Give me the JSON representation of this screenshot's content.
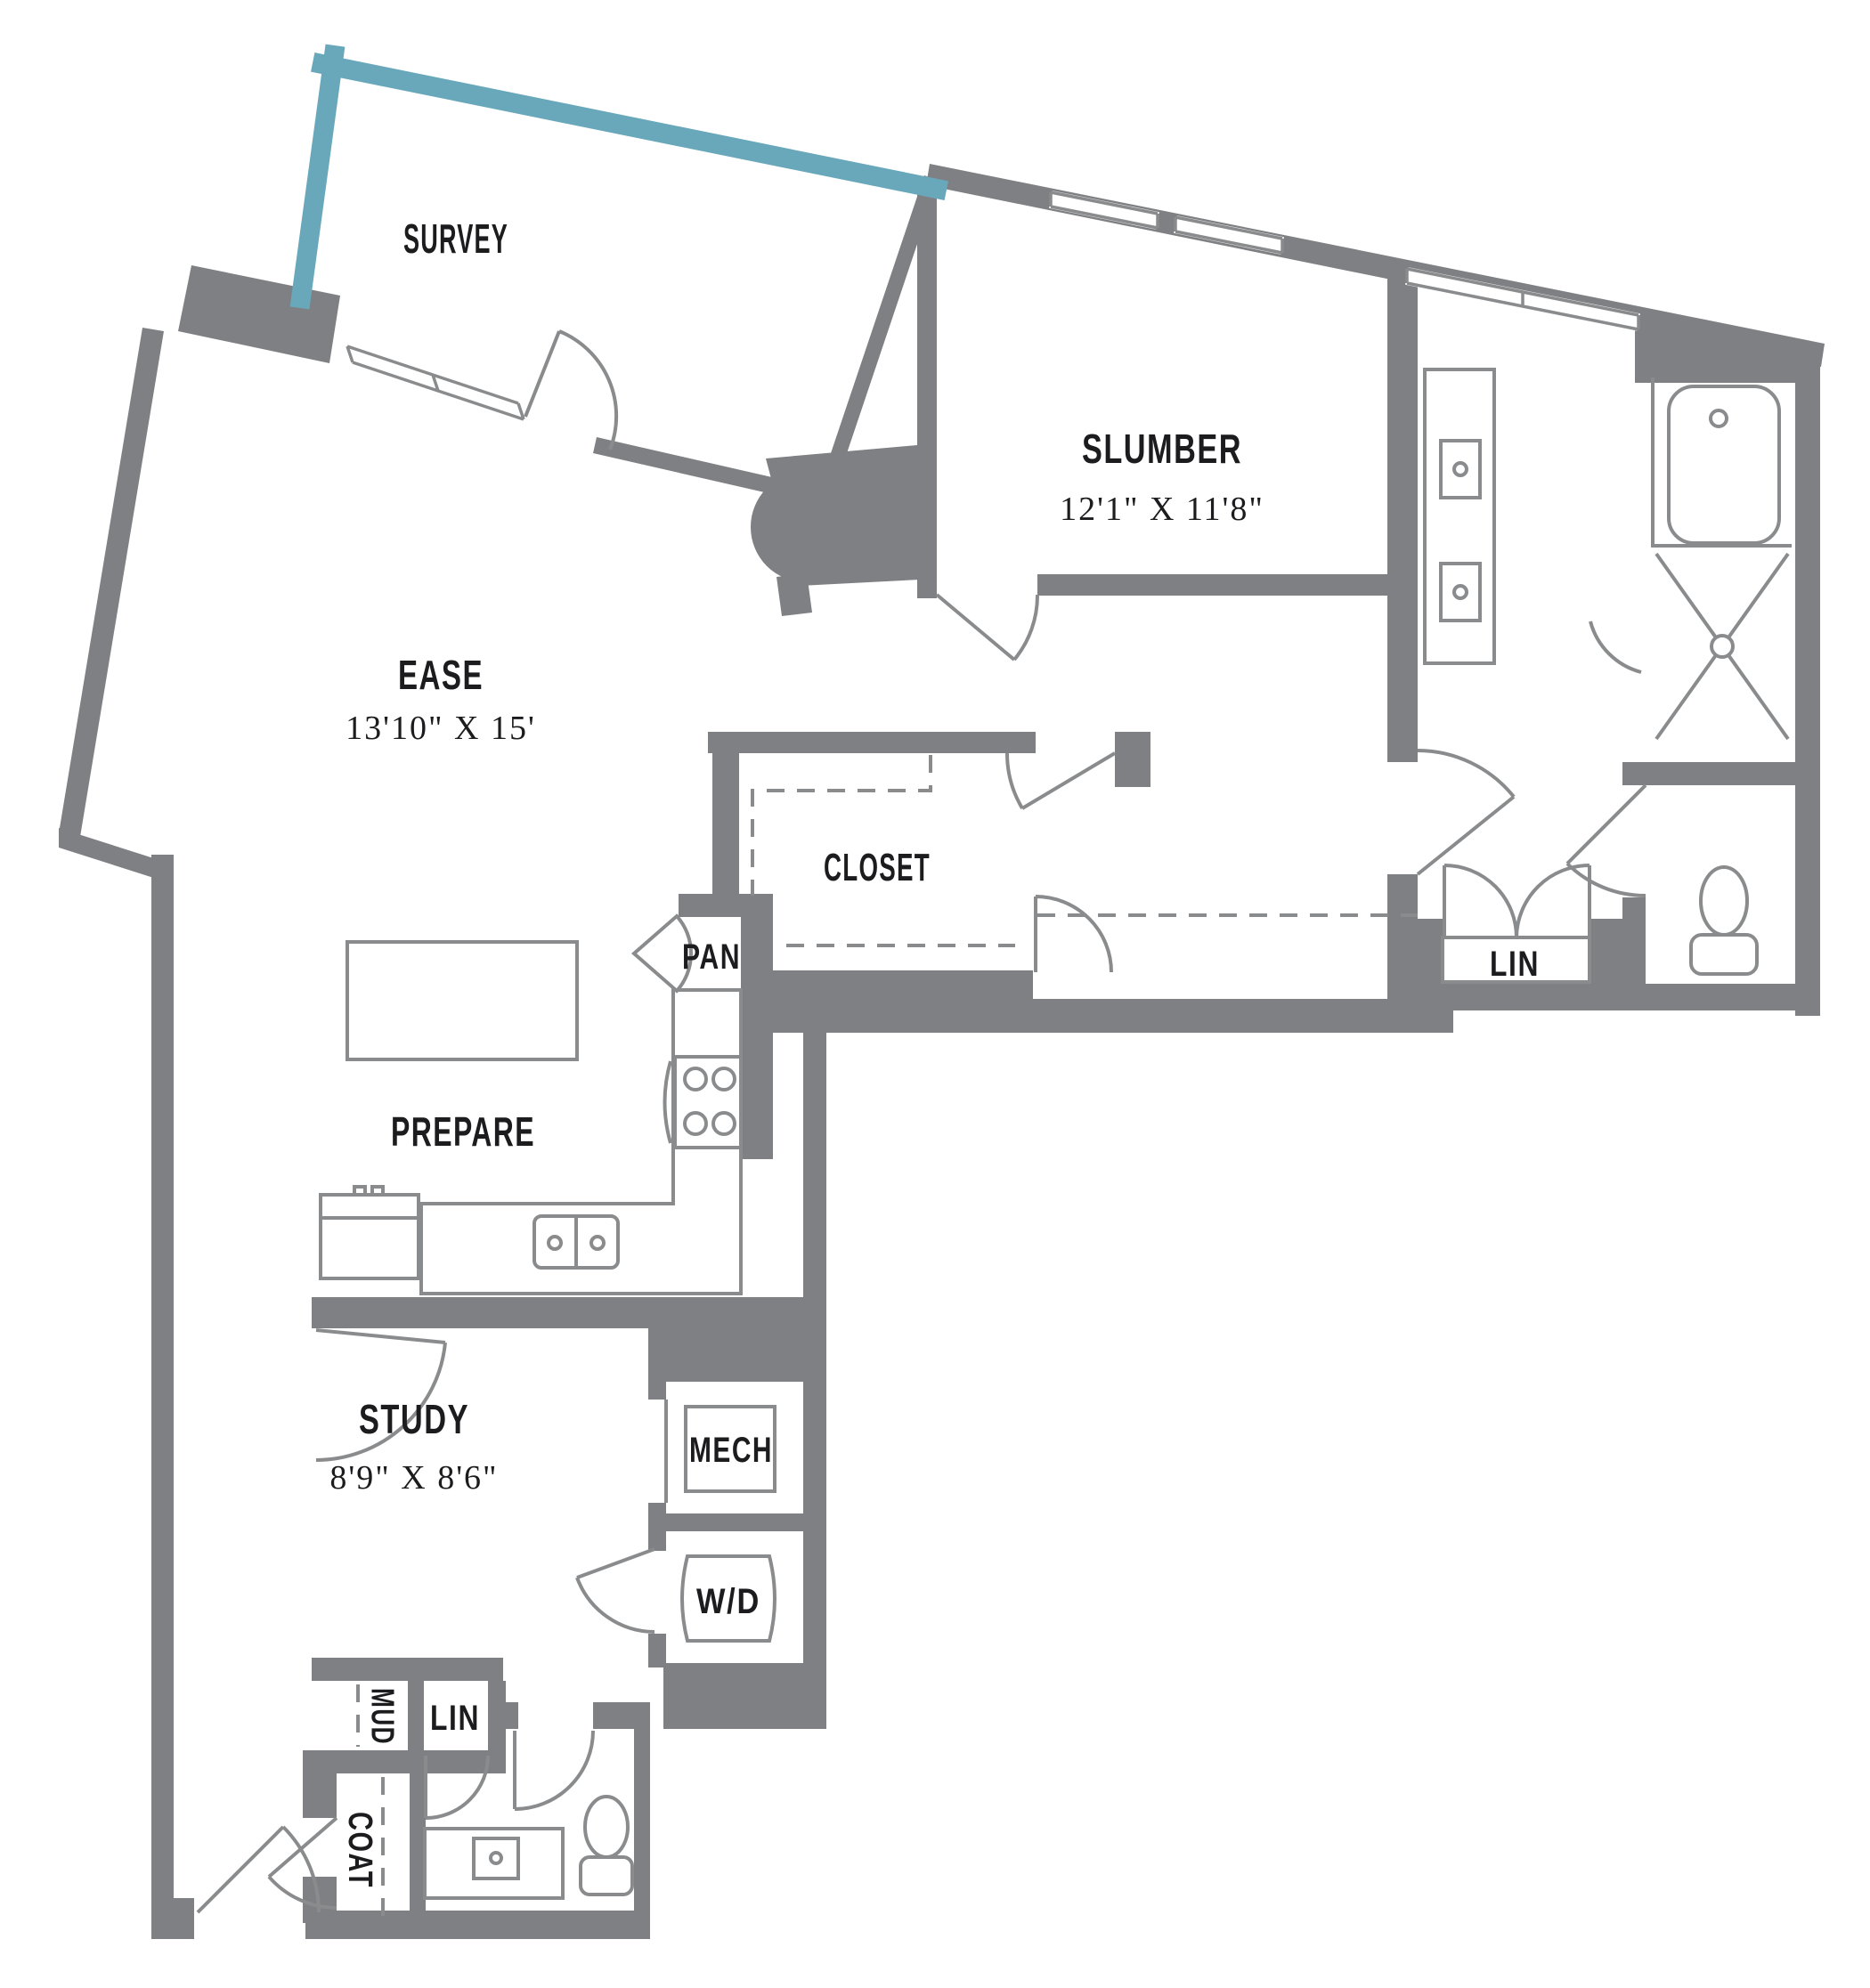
{
  "colors": {
    "wall_gray": "#7e8083",
    "balcony_teal": "#68a8ba",
    "fixture_line": "#898b8d",
    "label_text": "#1c1c1e",
    "background": "#ffffff"
  },
  "rooms": {
    "survey": {
      "label": "SURVEY"
    },
    "slumber": {
      "label": "SLUMBER",
      "dims": "12'1\" X 11'8\""
    },
    "ease": {
      "label": "EASE",
      "dims": "13'10\" X 15'"
    },
    "prepare": {
      "label": "PREPARE"
    },
    "closet": {
      "label": "CLOSET"
    },
    "study": {
      "label": "STUDY",
      "dims": "8'9\" X 8'6\""
    }
  },
  "utility": {
    "pantry": "PAN",
    "mechanical": "MECH",
    "washer_dryer": "W/D",
    "mud": "MUD",
    "linen_hall": "LIN",
    "coat": "COAT",
    "linen_bath": "LIN"
  },
  "fixtures": [
    "kitchen-island",
    "range-4-burner",
    "double-basin-sink",
    "refrigerator",
    "kitchen-counter",
    "bathtub",
    "walk-in-shower",
    "double-vanity",
    "toilet",
    "linen-double-doors",
    "powder-vanity",
    "powder-toilet",
    "washer-dryer-unit",
    "mechanical-unit",
    "entry-door",
    "balcony-edge",
    "windows",
    "structural-column"
  ]
}
